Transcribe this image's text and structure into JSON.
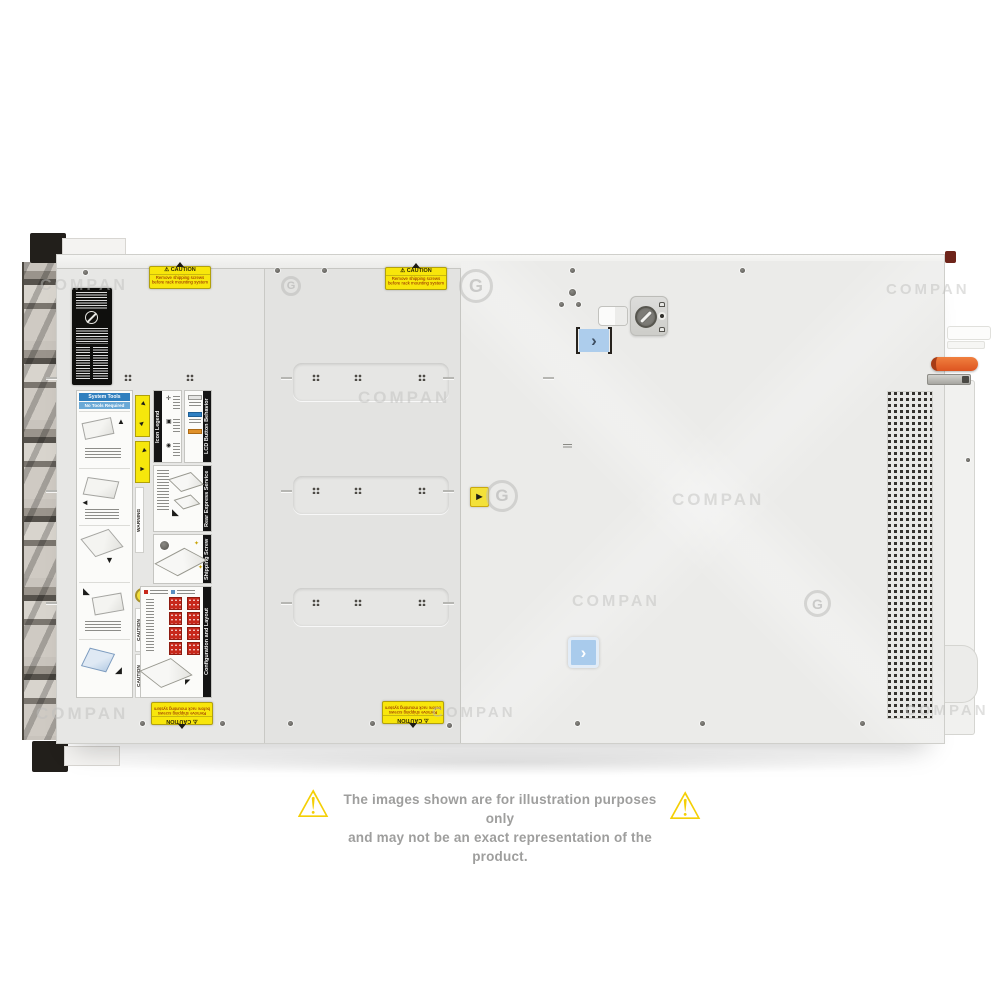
{
  "watermark": {
    "text": "COMPAN",
    "logo_letter": "G"
  },
  "icons": {
    "warning_triangle": "⚠",
    "chevron_right": "›",
    "hazard_arrow": "►"
  },
  "server": {
    "description": "rack server top view",
    "caution_sticker": {
      "title": "CAUTION",
      "line1": "Remove shipping screws",
      "line2": "before rack mounting system"
    },
    "service_labels": {
      "system_tools": "System Tools",
      "no_tools": "No Tools Required",
      "warning": "WARNING",
      "caution": "CAUTION",
      "icon_legend": "Icon Legend",
      "lcd_button": "LCD Button Behavior",
      "rear_tag": "Rear Express Service Tag",
      "shipping_screw": "Shipping Screw Removal",
      "config_layout": "Configuration and Layout"
    },
    "colors": {
      "chassis": "#e9e9e7",
      "caution_yellow": "#f8e60b",
      "latch_blue": "#a9cbec",
      "handle_orange": "#dd5420",
      "drive_red": "#c7281b"
    }
  },
  "disclaimer": {
    "line1": "The images shown are for illustration purposes only",
    "line2": "and may not be an exact representation of the product."
  }
}
